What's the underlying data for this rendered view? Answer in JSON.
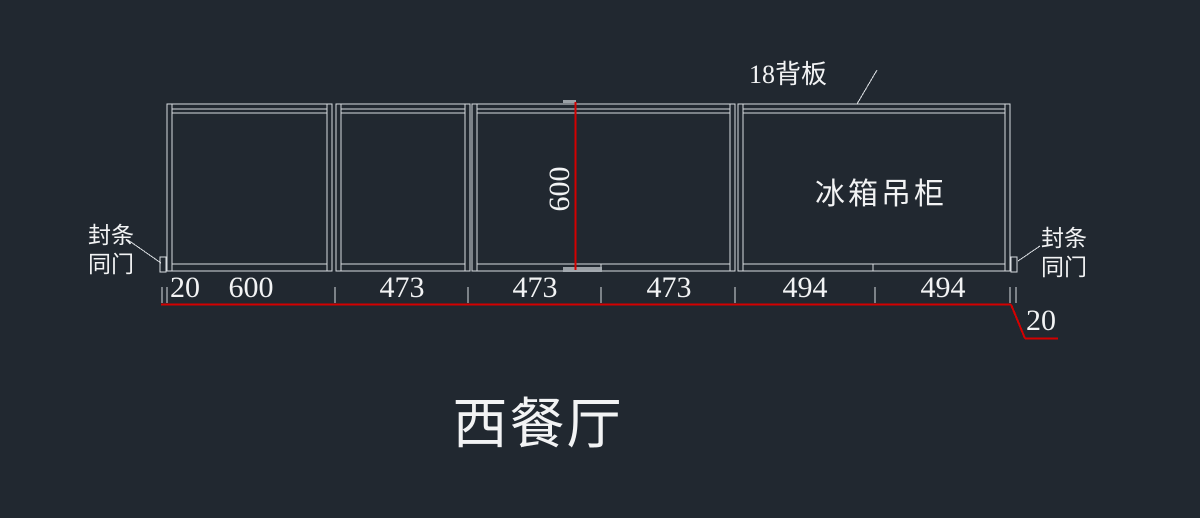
{
  "drawing": {
    "title": "西餐厅",
    "annotations": {
      "back_panel": "18背板",
      "cabinet": "冰箱吊柜",
      "seal_left": {
        "line1": "封条",
        "line2": "同门"
      },
      "seal_right": {
        "line1": "封条",
        "line2": "同门"
      }
    },
    "dimensions": {
      "height": "600",
      "bottom": [
        "20",
        "600",
        "473",
        "473",
        "473",
        "494",
        "494"
      ],
      "right_offset": "20"
    },
    "colors": {
      "background": "#212830",
      "lines": "#d7dbdf",
      "dimension": "#d40000",
      "text": "#f2f3f4"
    }
  }
}
